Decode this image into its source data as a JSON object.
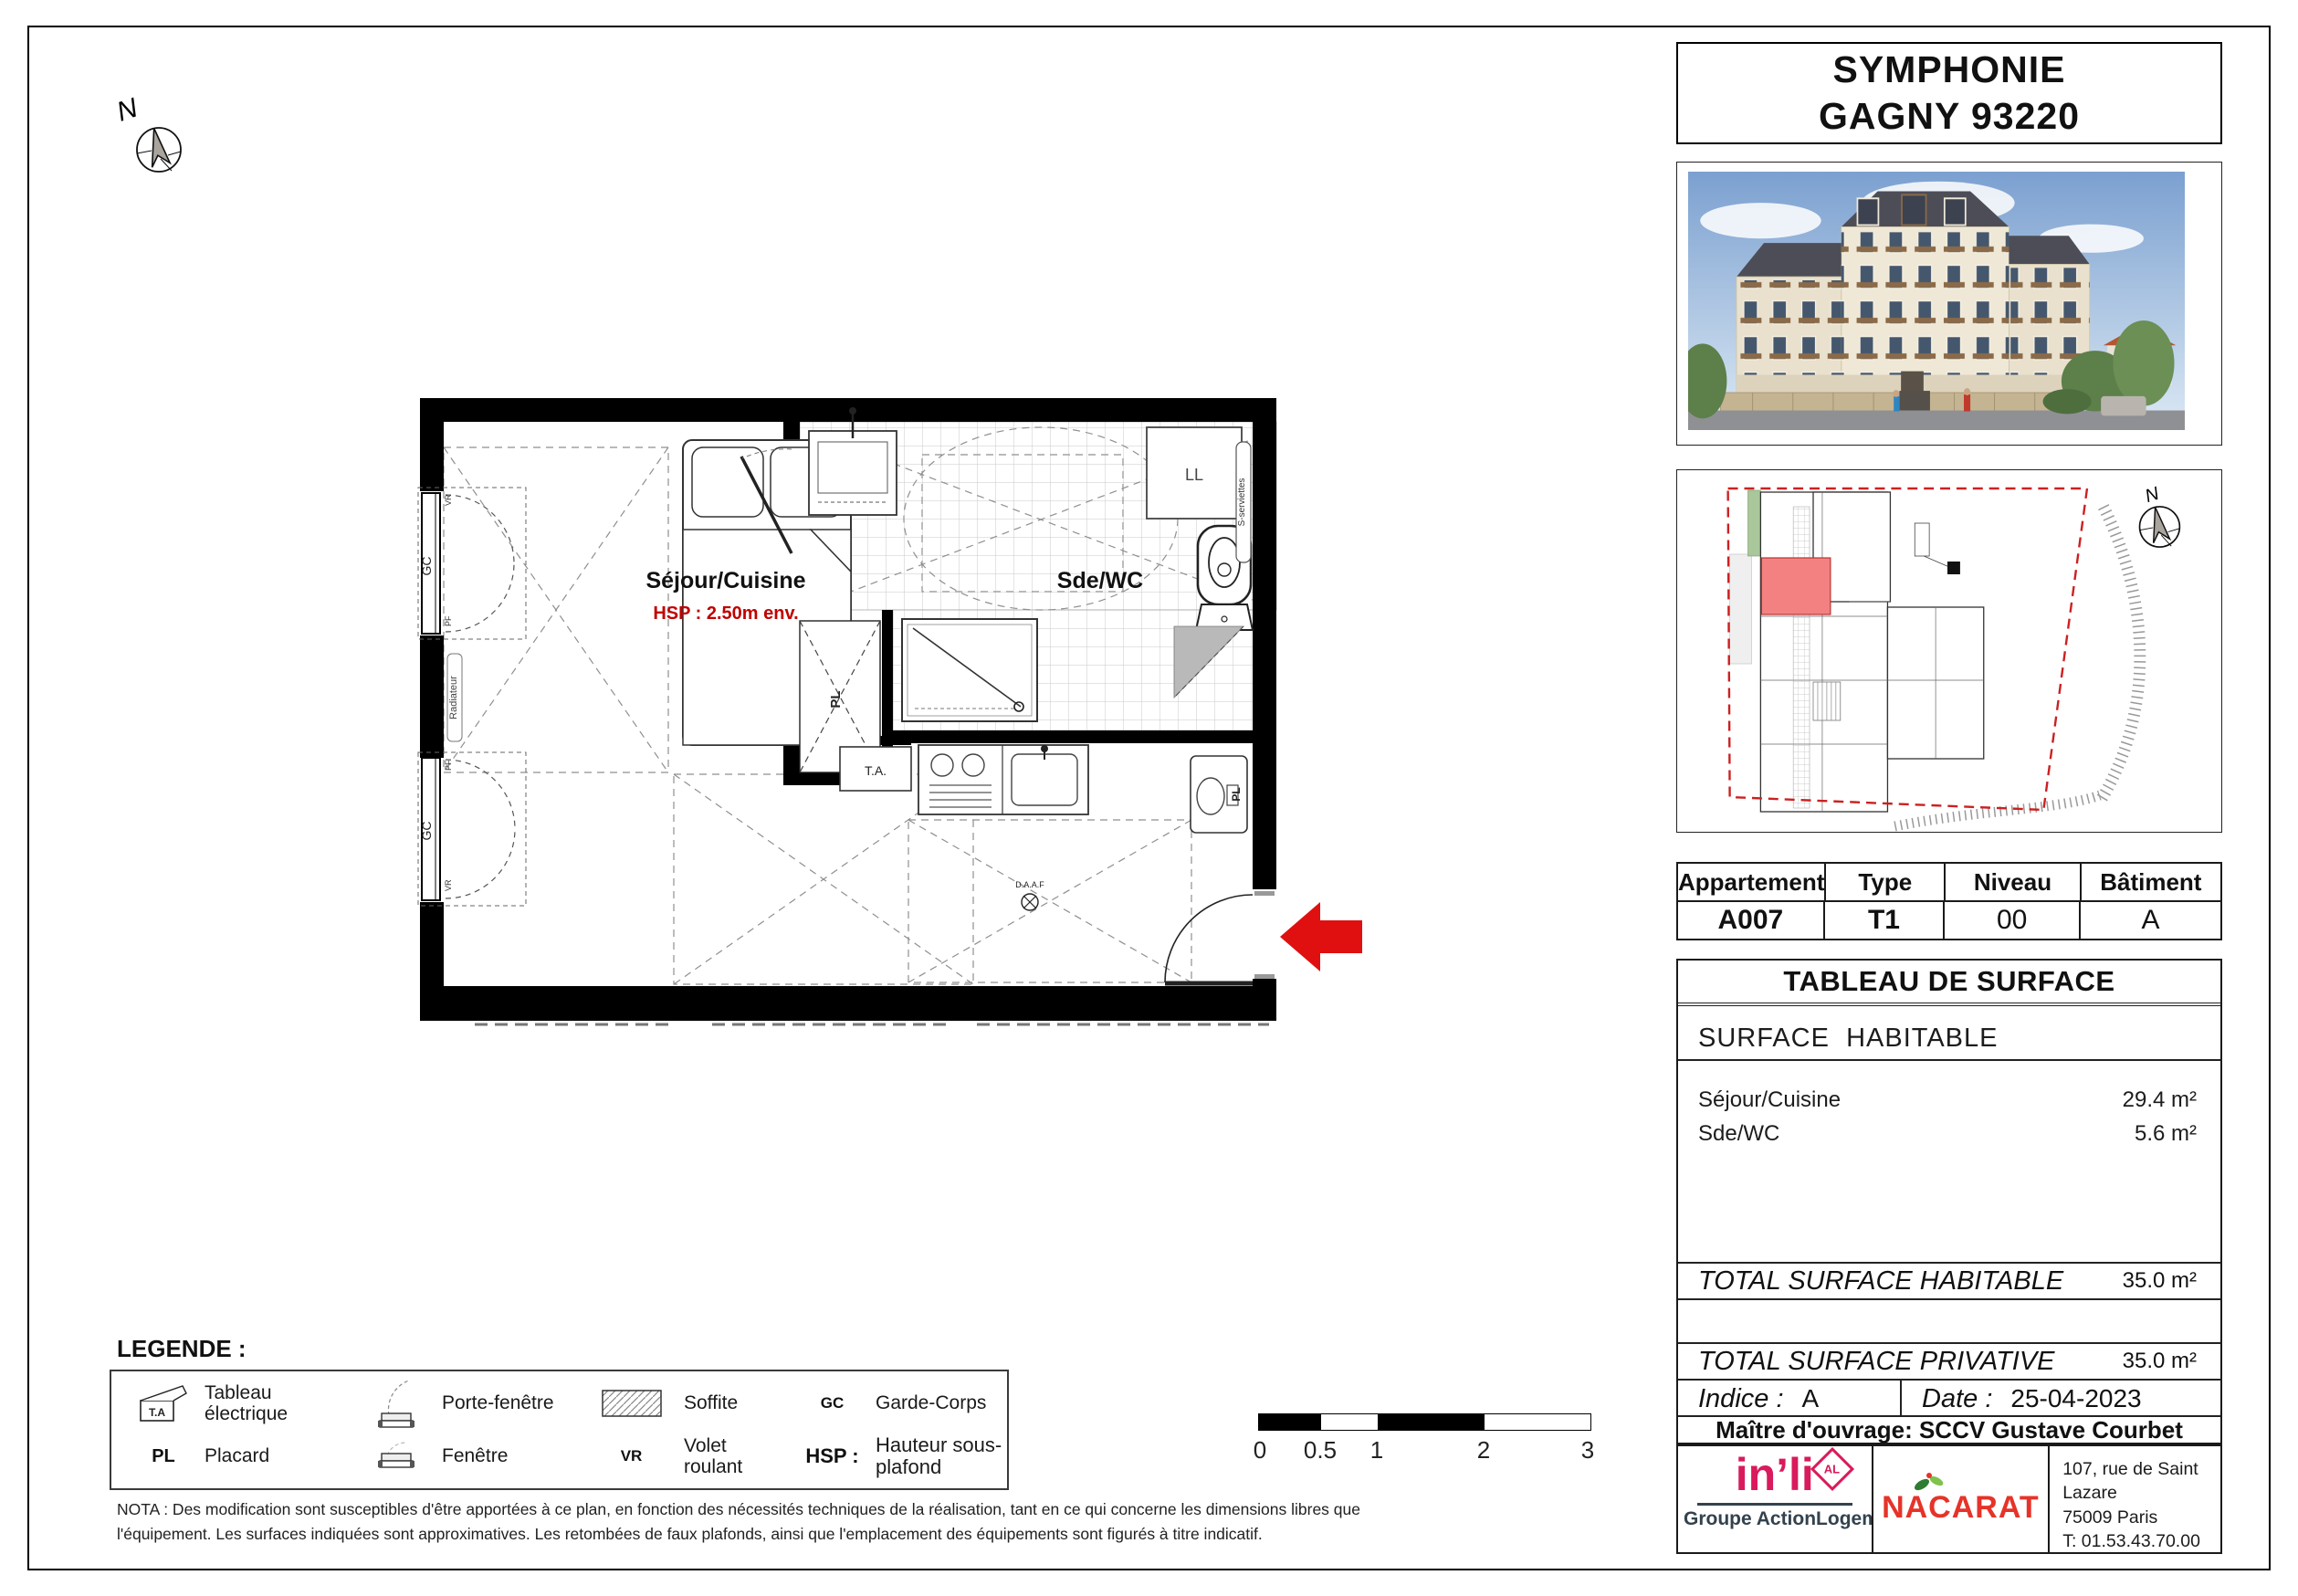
{
  "title": {
    "line1": "SYMPHONIE",
    "line2": "GAGNY 93220"
  },
  "plan": {
    "sejour_label": "Séjour/Cuisine",
    "sejour_hsp": "HSP : 2.50m env.",
    "sdewc_label": "Sde/WC",
    "gc": "GC",
    "pl": "PL",
    "ta_box": "T.A.",
    "ll": "LL",
    "vr": "VR",
    "pf": "PF",
    "radiateur": "Radiateur",
    "seche_serviettes": "S-serviettes",
    "daaf": "D.A.A.F",
    "north": "N"
  },
  "legend": {
    "title": "LEGENDE :",
    "items": [
      {
        "symbol": "T.A",
        "label": "Tableau électrique"
      },
      {
        "symbol": "",
        "label": "Porte-fenêtre"
      },
      {
        "symbol": "",
        "label": "Soffite"
      },
      {
        "symbol": "GC",
        "label": "Garde-Corps"
      },
      {
        "symbol": "PL",
        "label": "Placard"
      },
      {
        "symbol": "",
        "label": "Fenêtre"
      },
      {
        "symbol": "VR",
        "label": "Volet roulant"
      },
      {
        "symbol": "HSP :",
        "label": "Hauteur sous-plafond"
      }
    ]
  },
  "nota": {
    "line1": "NOTA : Des modification sont susceptibles d'être apportées à ce plan, en fonction des nécessités techniques de la réalisation, tant en ce qui concerne les dimensions libres que",
    "line2": "l'équipement. Les surfaces indiquées sont approximatives. Les retombées de faux plafonds, ainsi que l'emplacement des équipements sont figurés à titre indicatif."
  },
  "scalebar": {
    "labels": [
      "0",
      "0.5",
      "1",
      "2",
      "3"
    ]
  },
  "apartment": {
    "headers": [
      "Appartement",
      "Type",
      "Niveau",
      "Bâtiment"
    ],
    "values": [
      "A007",
      "T1",
      "00",
      "A"
    ]
  },
  "surface": {
    "title": "TABLEAU DE SURFACE",
    "section": "SURFACE  HABITABLE",
    "rows": [
      {
        "label": "Séjour/Cuisine",
        "value": "29.4 m²"
      },
      {
        "label": "Sde/WC",
        "value": "5.6 m²"
      }
    ],
    "total_habitable": {
      "label": "TOTAL SURFACE HABITABLE",
      "value": "35.0 m²"
    },
    "total_privative": {
      "label": "TOTAL SURFACE PRIVATIVE",
      "value": "35.0 m²"
    },
    "indice": {
      "label": "Indice :",
      "value": "A"
    },
    "date": {
      "label": "Date :",
      "value": "25-04-2023"
    },
    "moa": "Maître d'ouvrage: SCCV Gustave Courbet"
  },
  "footer": {
    "inli": {
      "name": "in’li",
      "badge": "AL",
      "group": "Groupe ActionLogement"
    },
    "nacarat": "NACARAT",
    "address": [
      "107, rue de Saint Lazare",
      "75009 Paris",
      "T: 01.53.43.70.00",
      "F: 01.53.43.70.10"
    ]
  },
  "colors": {
    "arrow_red": "#e01010",
    "hsp_red": "#c00000",
    "unit_pink": "#f38181",
    "boundary_red": "#cc2020",
    "inli_pink": "#d91a5d",
    "nacarat_red": "#e63329"
  }
}
